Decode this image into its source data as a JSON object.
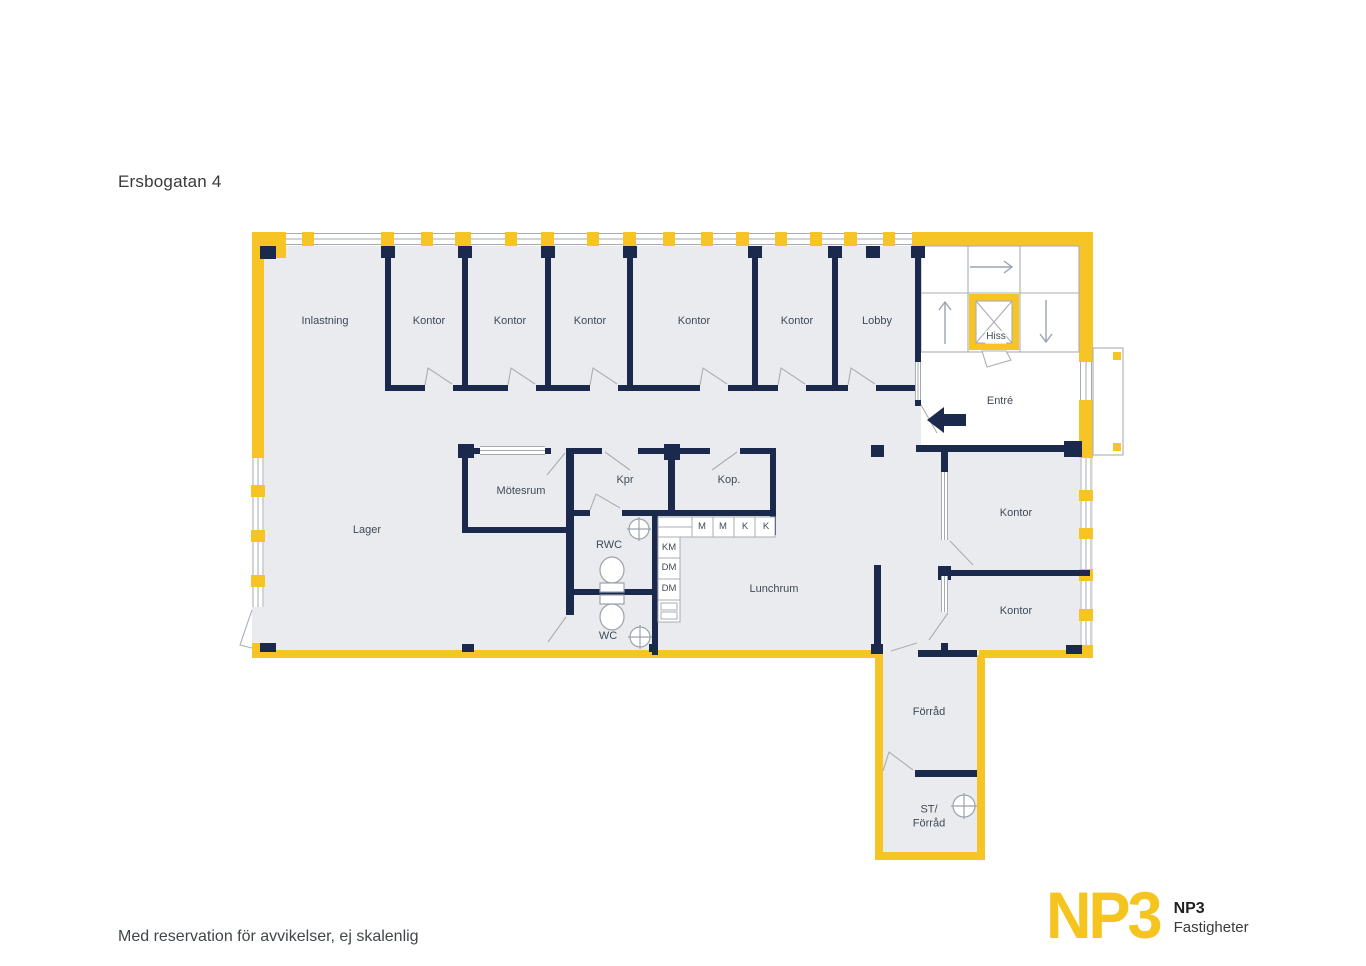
{
  "page": {
    "title": "Ersbogatan 4",
    "disclaimer": "Med reservation för avvikelser, ej skalenlig"
  },
  "brand": {
    "logo_text": "NP3",
    "company_line1": "NP3",
    "company_line2": "Fastigheter"
  },
  "colors": {
    "wall_yellow": "#f7c425",
    "wall_navy": "#1b2a4c",
    "floor_gray": "#eaebee",
    "line_gray": "#a6abb2",
    "label_color": "#3f4a57"
  },
  "rooms": [
    {
      "label": "Inlastning"
    },
    {
      "label": "Kontor"
    },
    {
      "label": "Kontor"
    },
    {
      "label": "Kontor"
    },
    {
      "label": "Kontor"
    },
    {
      "label": "Kontor"
    },
    {
      "label": "Lobby"
    },
    {
      "label": "Hiss"
    },
    {
      "label": "Entré"
    },
    {
      "label": "Lager"
    },
    {
      "label": "Mötesrum"
    },
    {
      "label": "Kpr"
    },
    {
      "label": "Kop."
    },
    {
      "label": "RWC"
    },
    {
      "label": "WC"
    },
    {
      "label": "Lunchrum"
    },
    {
      "label": "Kontor"
    },
    {
      "label": "Kontor"
    },
    {
      "label": "Förråd"
    },
    {
      "line1": "ST/",
      "line2": "Förråd"
    }
  ],
  "appliances": [
    {
      "label": "KM"
    },
    {
      "label": "DM"
    },
    {
      "label": "DM"
    },
    {
      "label": "M"
    },
    {
      "label": "M"
    },
    {
      "label": "K"
    },
    {
      "label": "K"
    }
  ]
}
